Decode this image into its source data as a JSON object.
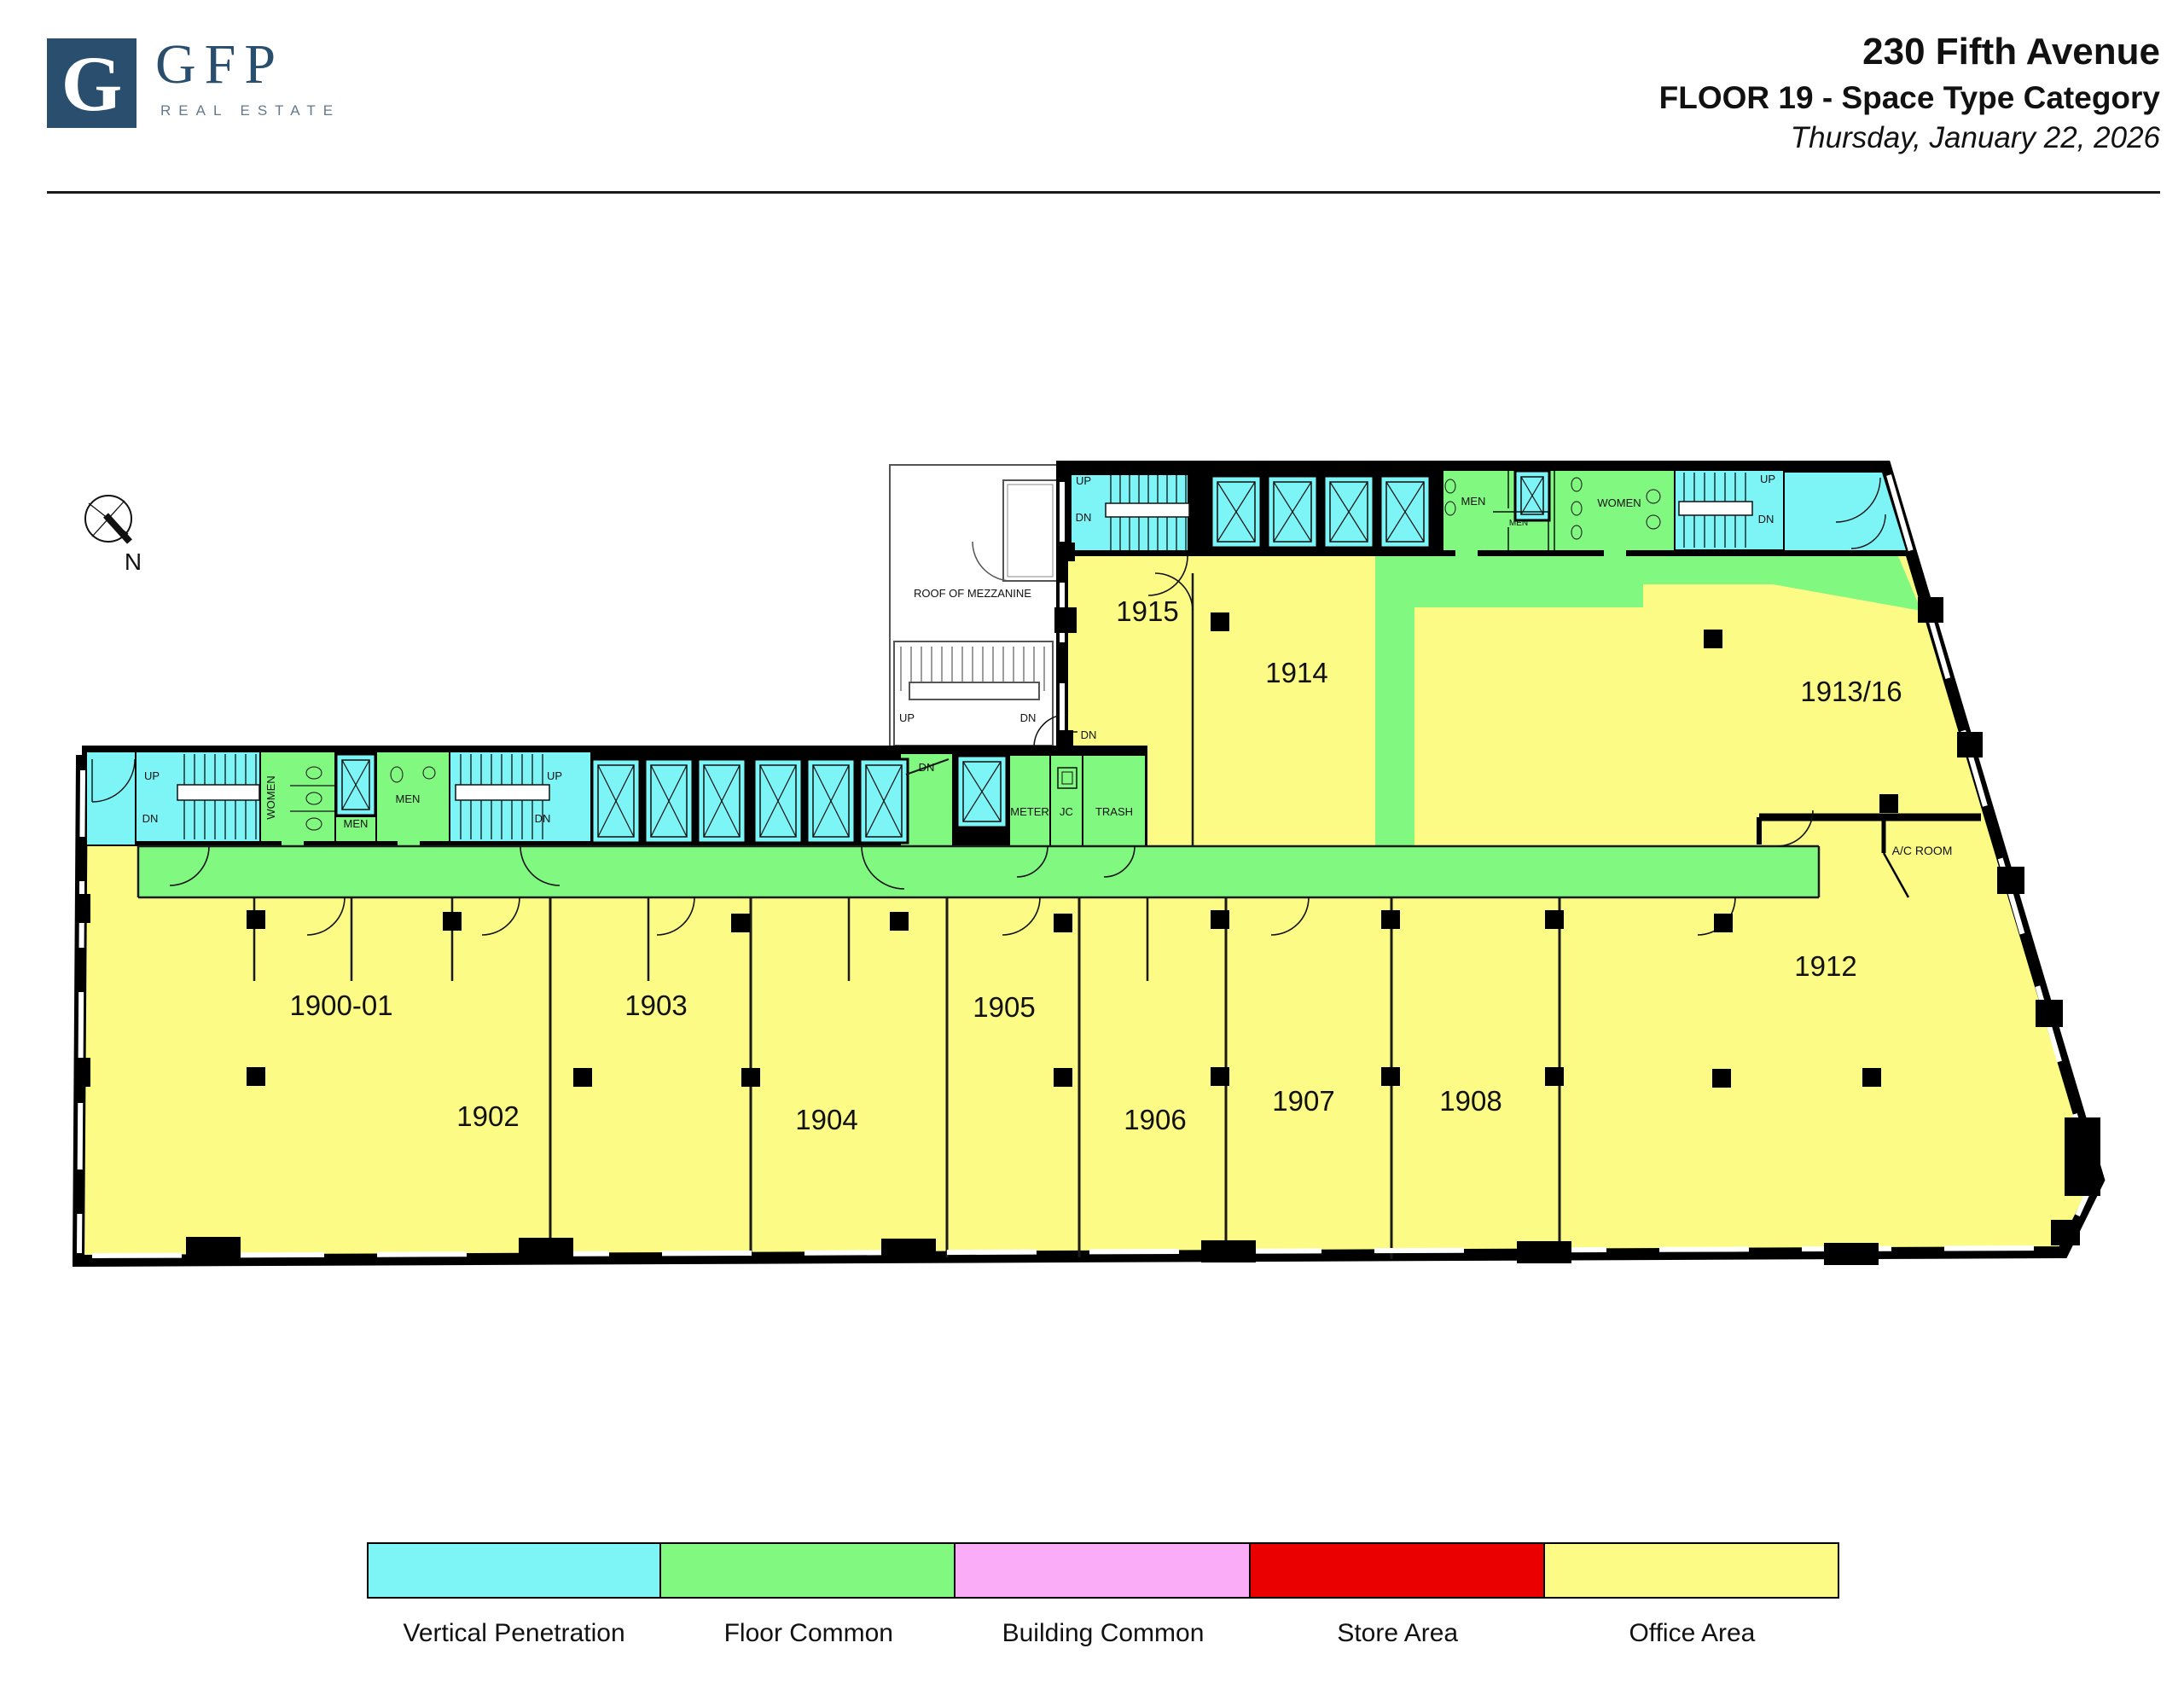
{
  "header": {
    "brand": "GFP",
    "brand_initial": "G",
    "brand_tagline": "REAL ESTATE",
    "title": "230 Fifth Avenue",
    "subtitle": "FLOOR 19 - Space Type Category",
    "date": "Thursday, January 22, 2026"
  },
  "compass": {
    "north_label": "N"
  },
  "plan": {
    "rooms": [
      {
        "id": "1900-01",
        "label": "1900-01"
      },
      {
        "id": "1902",
        "label": "1902"
      },
      {
        "id": "1903",
        "label": "1903"
      },
      {
        "id": "1904",
        "label": "1904"
      },
      {
        "id": "1905",
        "label": "1905"
      },
      {
        "id": "1906",
        "label": "1906"
      },
      {
        "id": "1907",
        "label": "1907"
      },
      {
        "id": "1908",
        "label": "1908"
      },
      {
        "id": "1912",
        "label": "1912"
      },
      {
        "id": "1913/16",
        "label": "1913/16"
      },
      {
        "id": "1914",
        "label": "1914"
      },
      {
        "id": "1915",
        "label": "1915"
      }
    ],
    "text": {
      "up": "UP",
      "dn": "DN",
      "men": "MEN",
      "women": "WOMEN",
      "meter": "METER",
      "jc": "JC",
      "trash": "TRASH",
      "roof_of_mezzanine": "ROOF OF MEZZANINE",
      "ac_room": "A/C ROOM"
    }
  },
  "legend": {
    "items": [
      {
        "label": "Vertical Penetration",
        "color": "#7DF4F6"
      },
      {
        "label": "Floor Common",
        "color": "#81F981"
      },
      {
        "label": "Building Common",
        "color": "#FAACF6"
      },
      {
        "label": "Store Area",
        "color": "#EB0000"
      },
      {
        "label": "Office Area",
        "color": "#FBFB86"
      }
    ]
  }
}
